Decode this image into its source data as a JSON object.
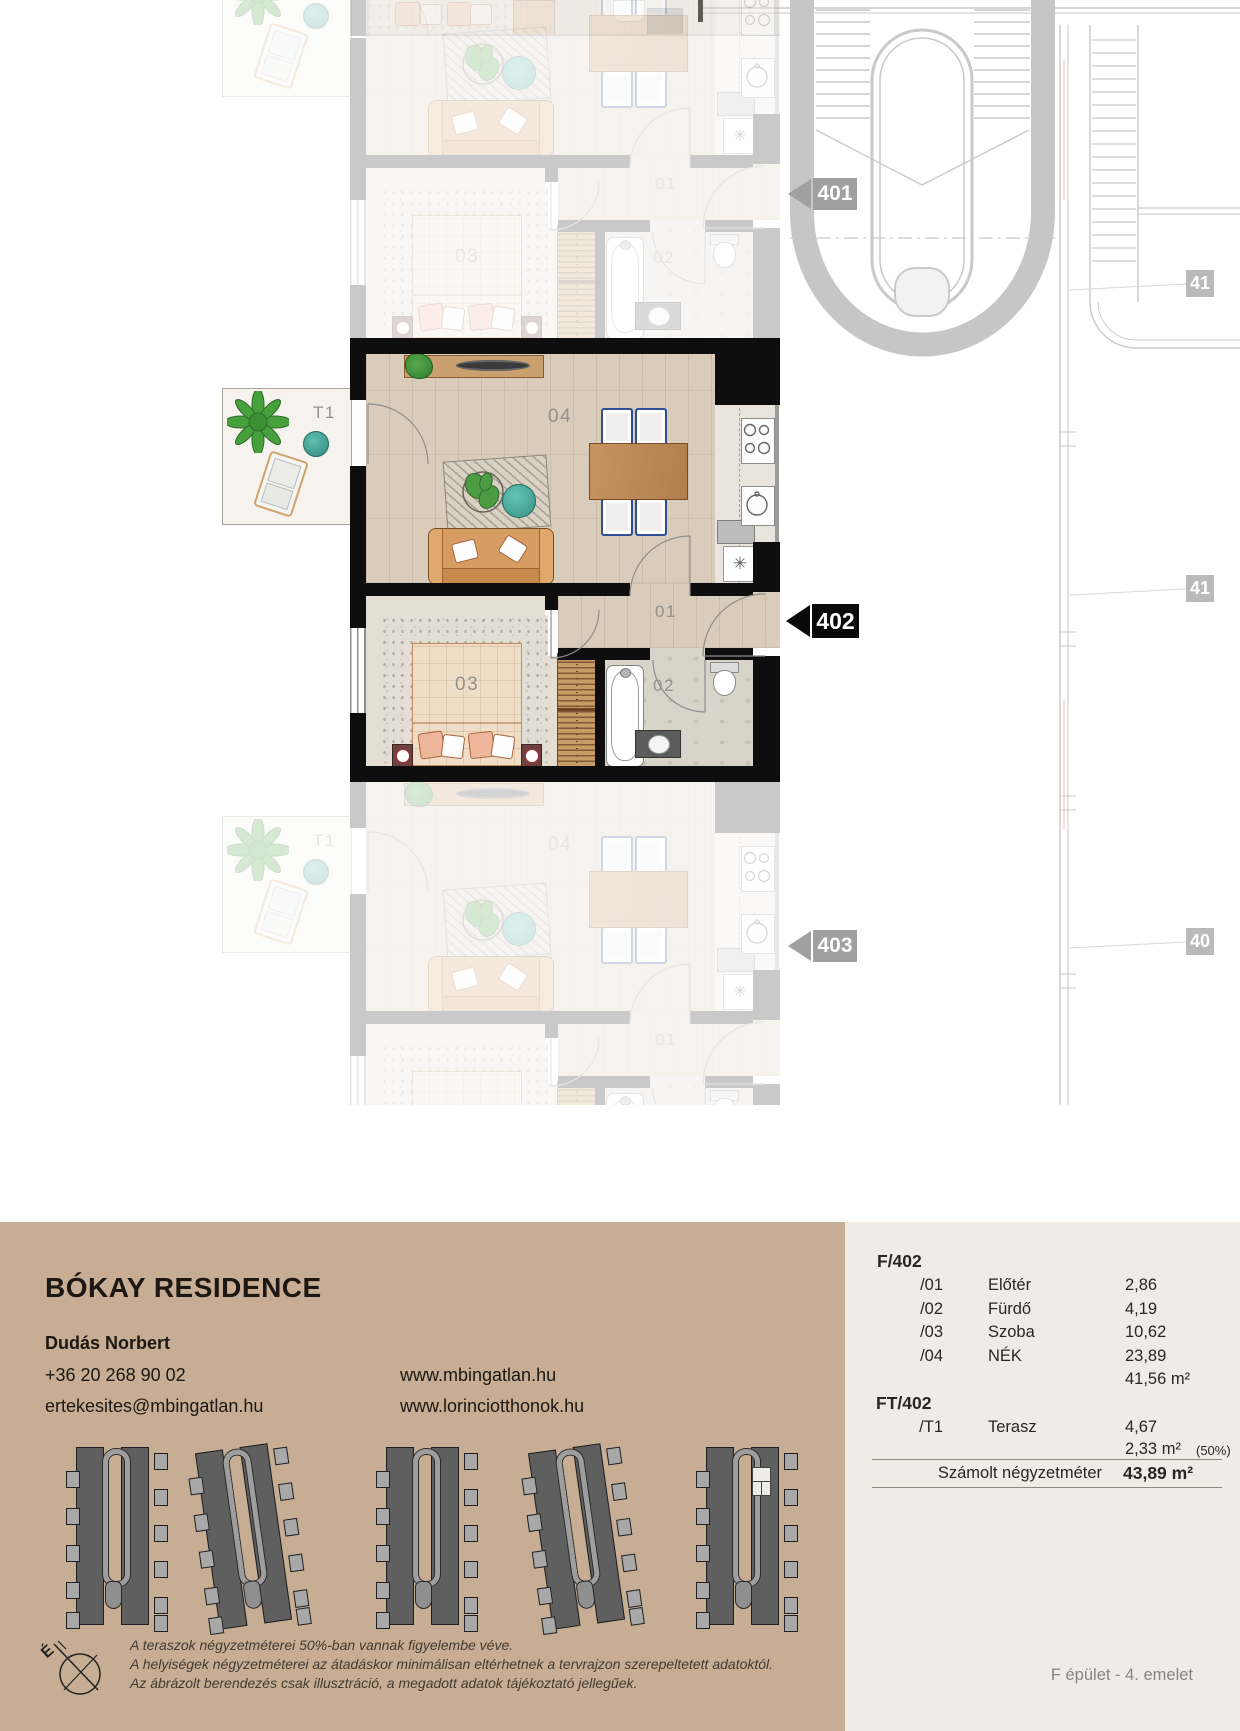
{
  "brand": {
    "title": "BÓKAY RESIDENCE"
  },
  "contact": {
    "agent": "Dudás Norbert",
    "phone": "+36 20 268 90 02",
    "email": "ertekesites@mbingatlan.hu",
    "web1": "www.mbingatlan.hu",
    "web2": "www.lorinciotthonok.hu"
  },
  "plan": {
    "rooms": {
      "terrace": "T1",
      "living": "04",
      "bedroom": "03",
      "hall": "01",
      "bath": "02"
    },
    "markers": {
      "prev": "401",
      "current": "402",
      "next": "403",
      "side_top": "41",
      "side_mid": "41",
      "side_bottom": "40"
    },
    "kitchen_symbol": "✳"
  },
  "area_table": {
    "group1_label": "F/402",
    "group1_rows": [
      {
        "no": "/01",
        "name": "Előtér",
        "value": "2,86"
      },
      {
        "no": "/02",
        "name": "Fürdő",
        "value": "4,19"
      },
      {
        "no": "/03",
        "name": "Szoba",
        "value": "10,62"
      },
      {
        "no": "/04",
        "name": "NÉK",
        "value": "23,89"
      }
    ],
    "group1_subtotal": "41,56 m²",
    "group2_label": "FT/402",
    "group2_rows": [
      {
        "no": "/T1",
        "name": "Terasz",
        "value": "4,67"
      }
    ],
    "group2_subtotal": "2,33 m²",
    "group2_subnote": "(50%)",
    "total_label": "Számolt négyzetméter",
    "total_value": "43,89 m²"
  },
  "disclaimer": {
    "line1": "A teraszok négyzetméterei 50%-ban vannak figyelembe véve.",
    "line2": "A helyiségek négyzetméterei az átadáskor minimálisan eltérhetnek a tervrajzon szerepeltetett adatoktól.",
    "line3": "Az ábrázolt berendezés csak illusztráció, a megadott adatok tájékoztató jellegűek."
  },
  "footer": {
    "location": "F épület - 4. emelet"
  },
  "compass": {
    "north": "É"
  },
  "colors": {
    "panel_tan": "#c6ad93",
    "panel_beige": "#f1ebe5",
    "wall": "#0e0e0e",
    "accent_teal": "#49b2a4",
    "plant_green": "#46a03c"
  }
}
